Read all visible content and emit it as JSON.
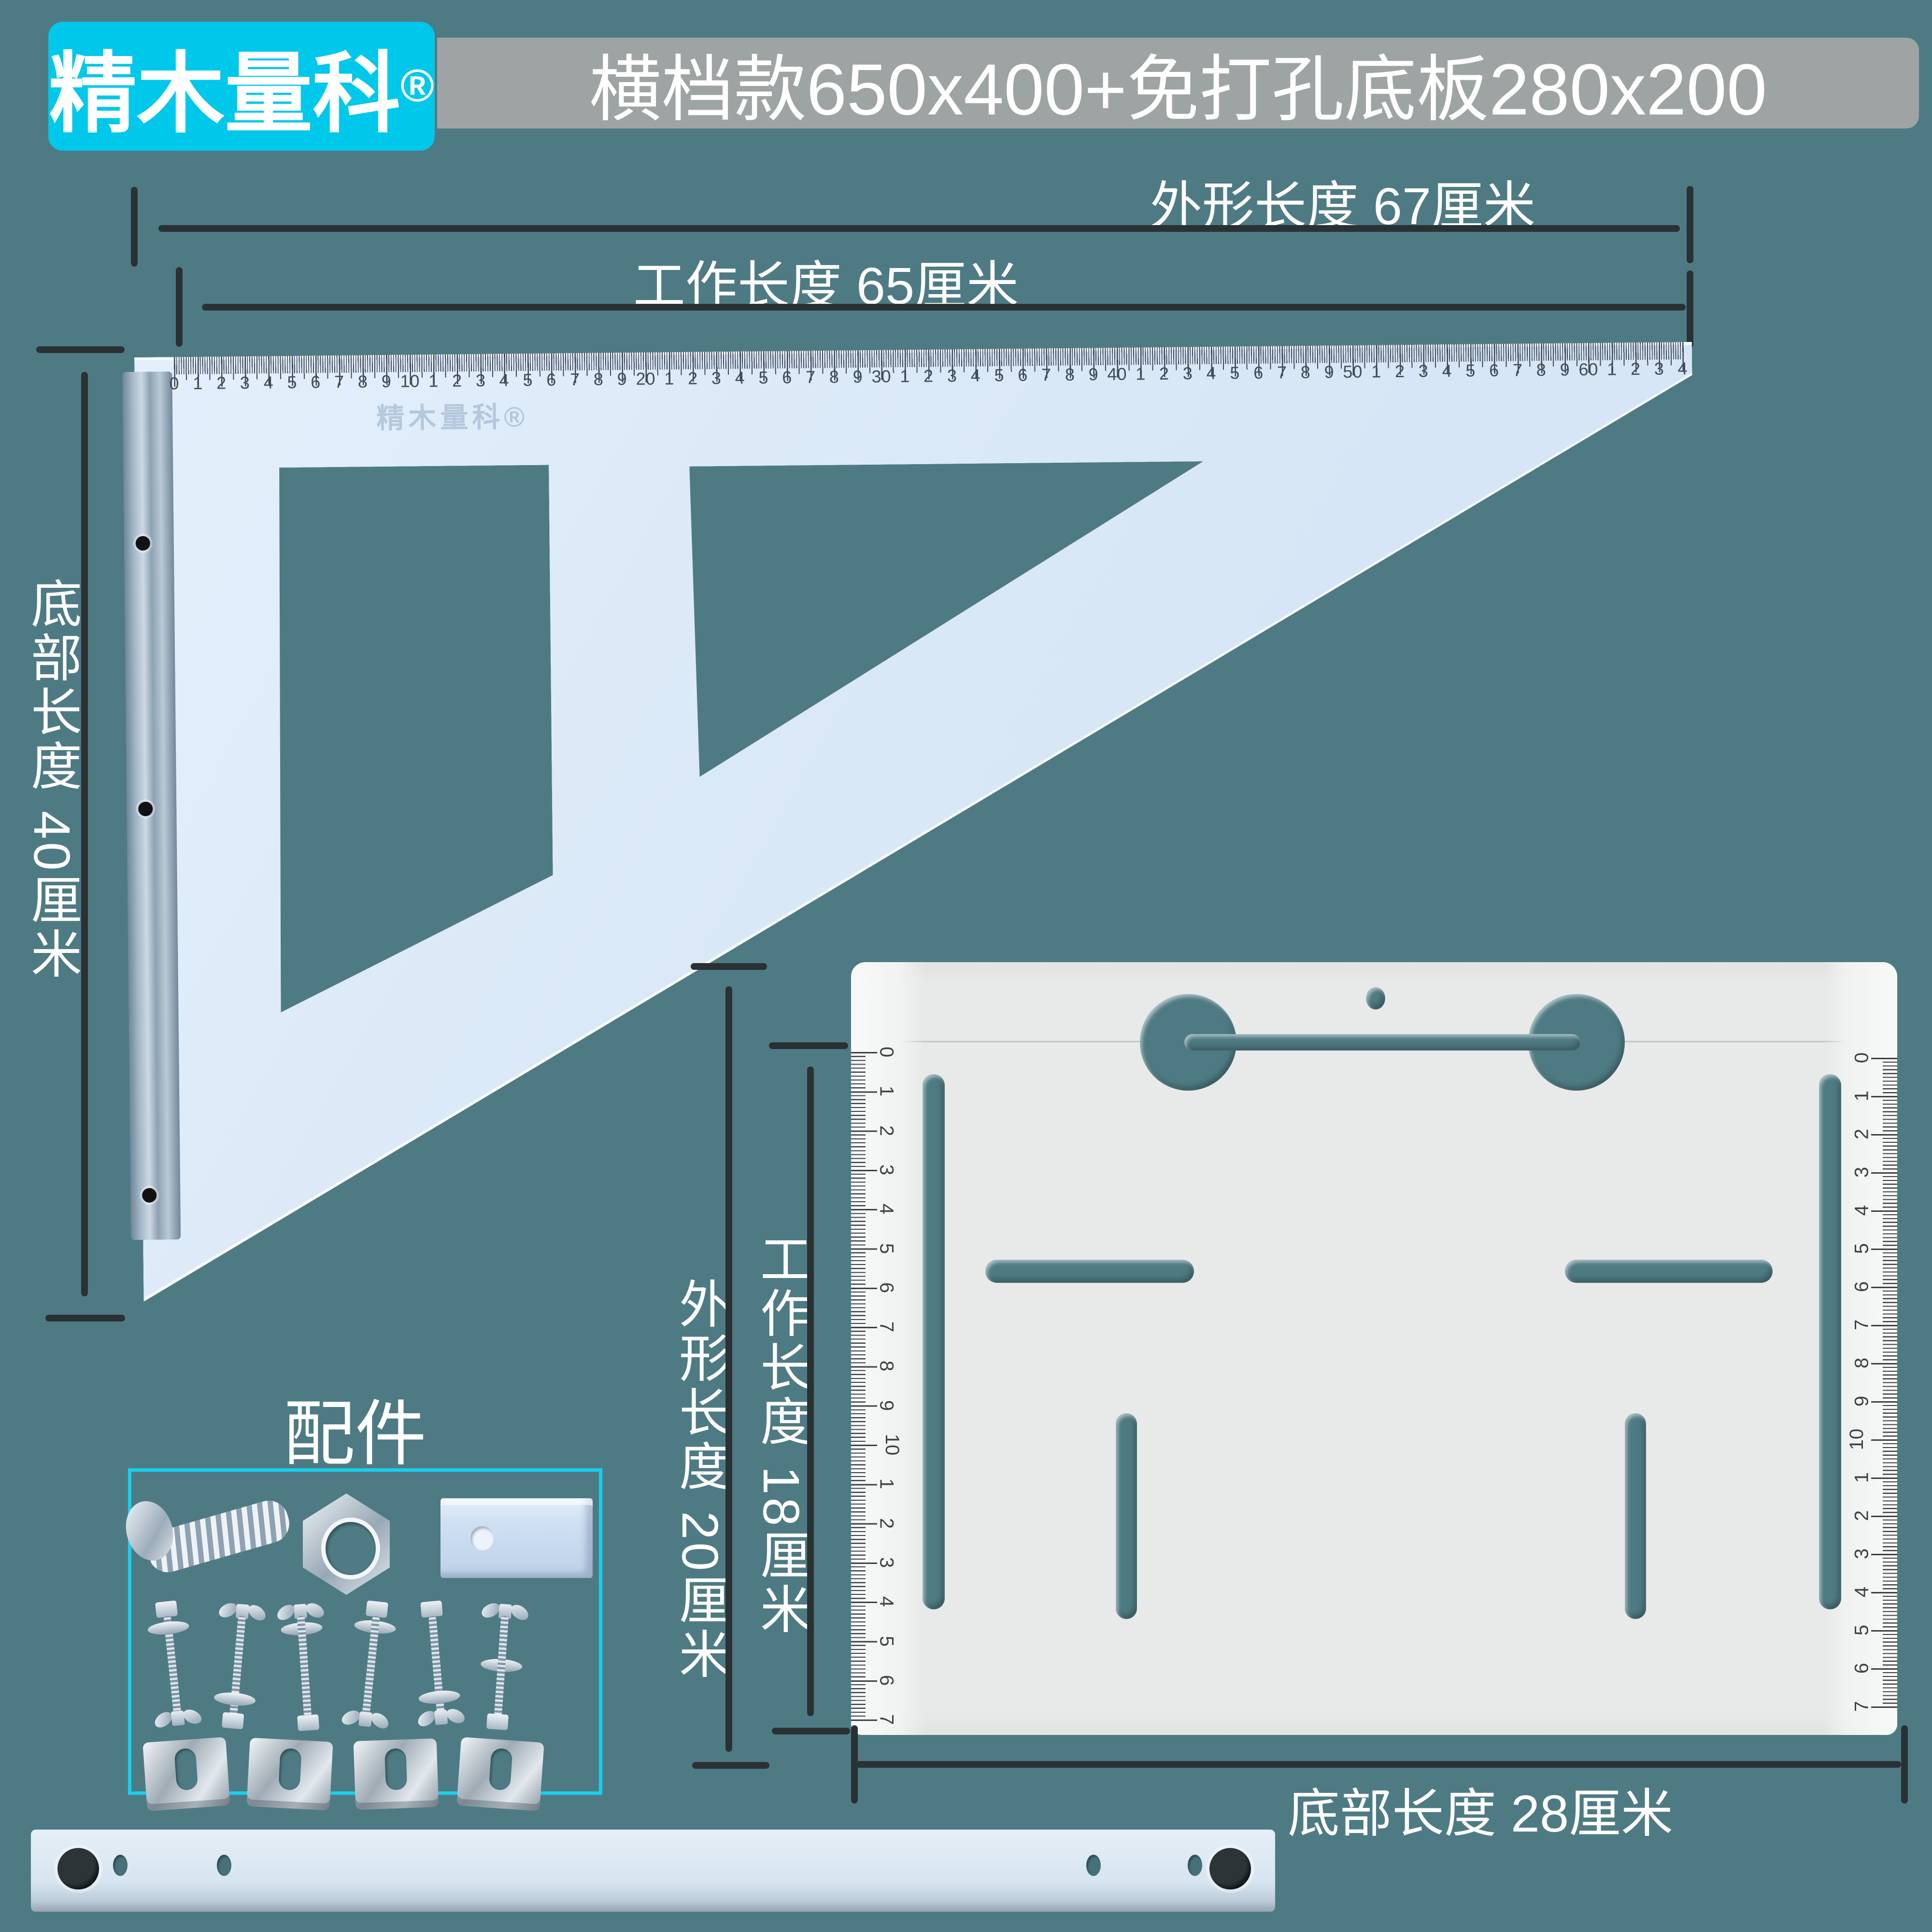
{
  "colors": {
    "background": "#4E7B83",
    "accent_cyan": "#00C8EA",
    "box_border_cyan": "#17CFEF",
    "title_gray": "#9EA4A3",
    "dimension_line": "#2A3134",
    "triangle_fill": "#D9E8F7",
    "plate_fill": "#E8EAE9",
    "text": "#FFFFFF"
  },
  "logo": {
    "text": "精木量科",
    "reg": "®"
  },
  "title": {
    "text": "横档款650x400+免打孔底板280x200"
  },
  "annotations": {
    "outer_top": {
      "label": "外形长度 67厘米"
    },
    "work_top": {
      "label": "工作长度 65厘米"
    },
    "bottom_left": {
      "label": "底部长度 40厘米"
    },
    "outer_mid": {
      "label": "外形长度 20厘米"
    },
    "work_mid": {
      "label": "工作长度 18厘米"
    },
    "bottom_plate": {
      "label": "底部长度 28厘米"
    }
  },
  "triangle": {
    "watermark": "精木量科®",
    "ruler_labels": "0 1 2 3 4 5 6 7 8 9 10 1 2 3 4 5 6 7 8 9 20 1 2 3 4 5 6 7 8 9 30 1 2 3 4 5 6 7 8 9 40 1 2 3 4 5 6 7 8 9 50 1 2 3 4 5 6 7 8 9 60 1 2 3 4"
  },
  "plate": {
    "left_ruler_labels": "0 1 2 3 4 5 6 7 8 9 10 1 2 3 4 5 6 7",
    "right_ruler_labels": "0 1 2 3 4 5 6 7 8 9 10 1 2 3 4 5 6 7"
  },
  "accessories": {
    "label": "配件"
  }
}
